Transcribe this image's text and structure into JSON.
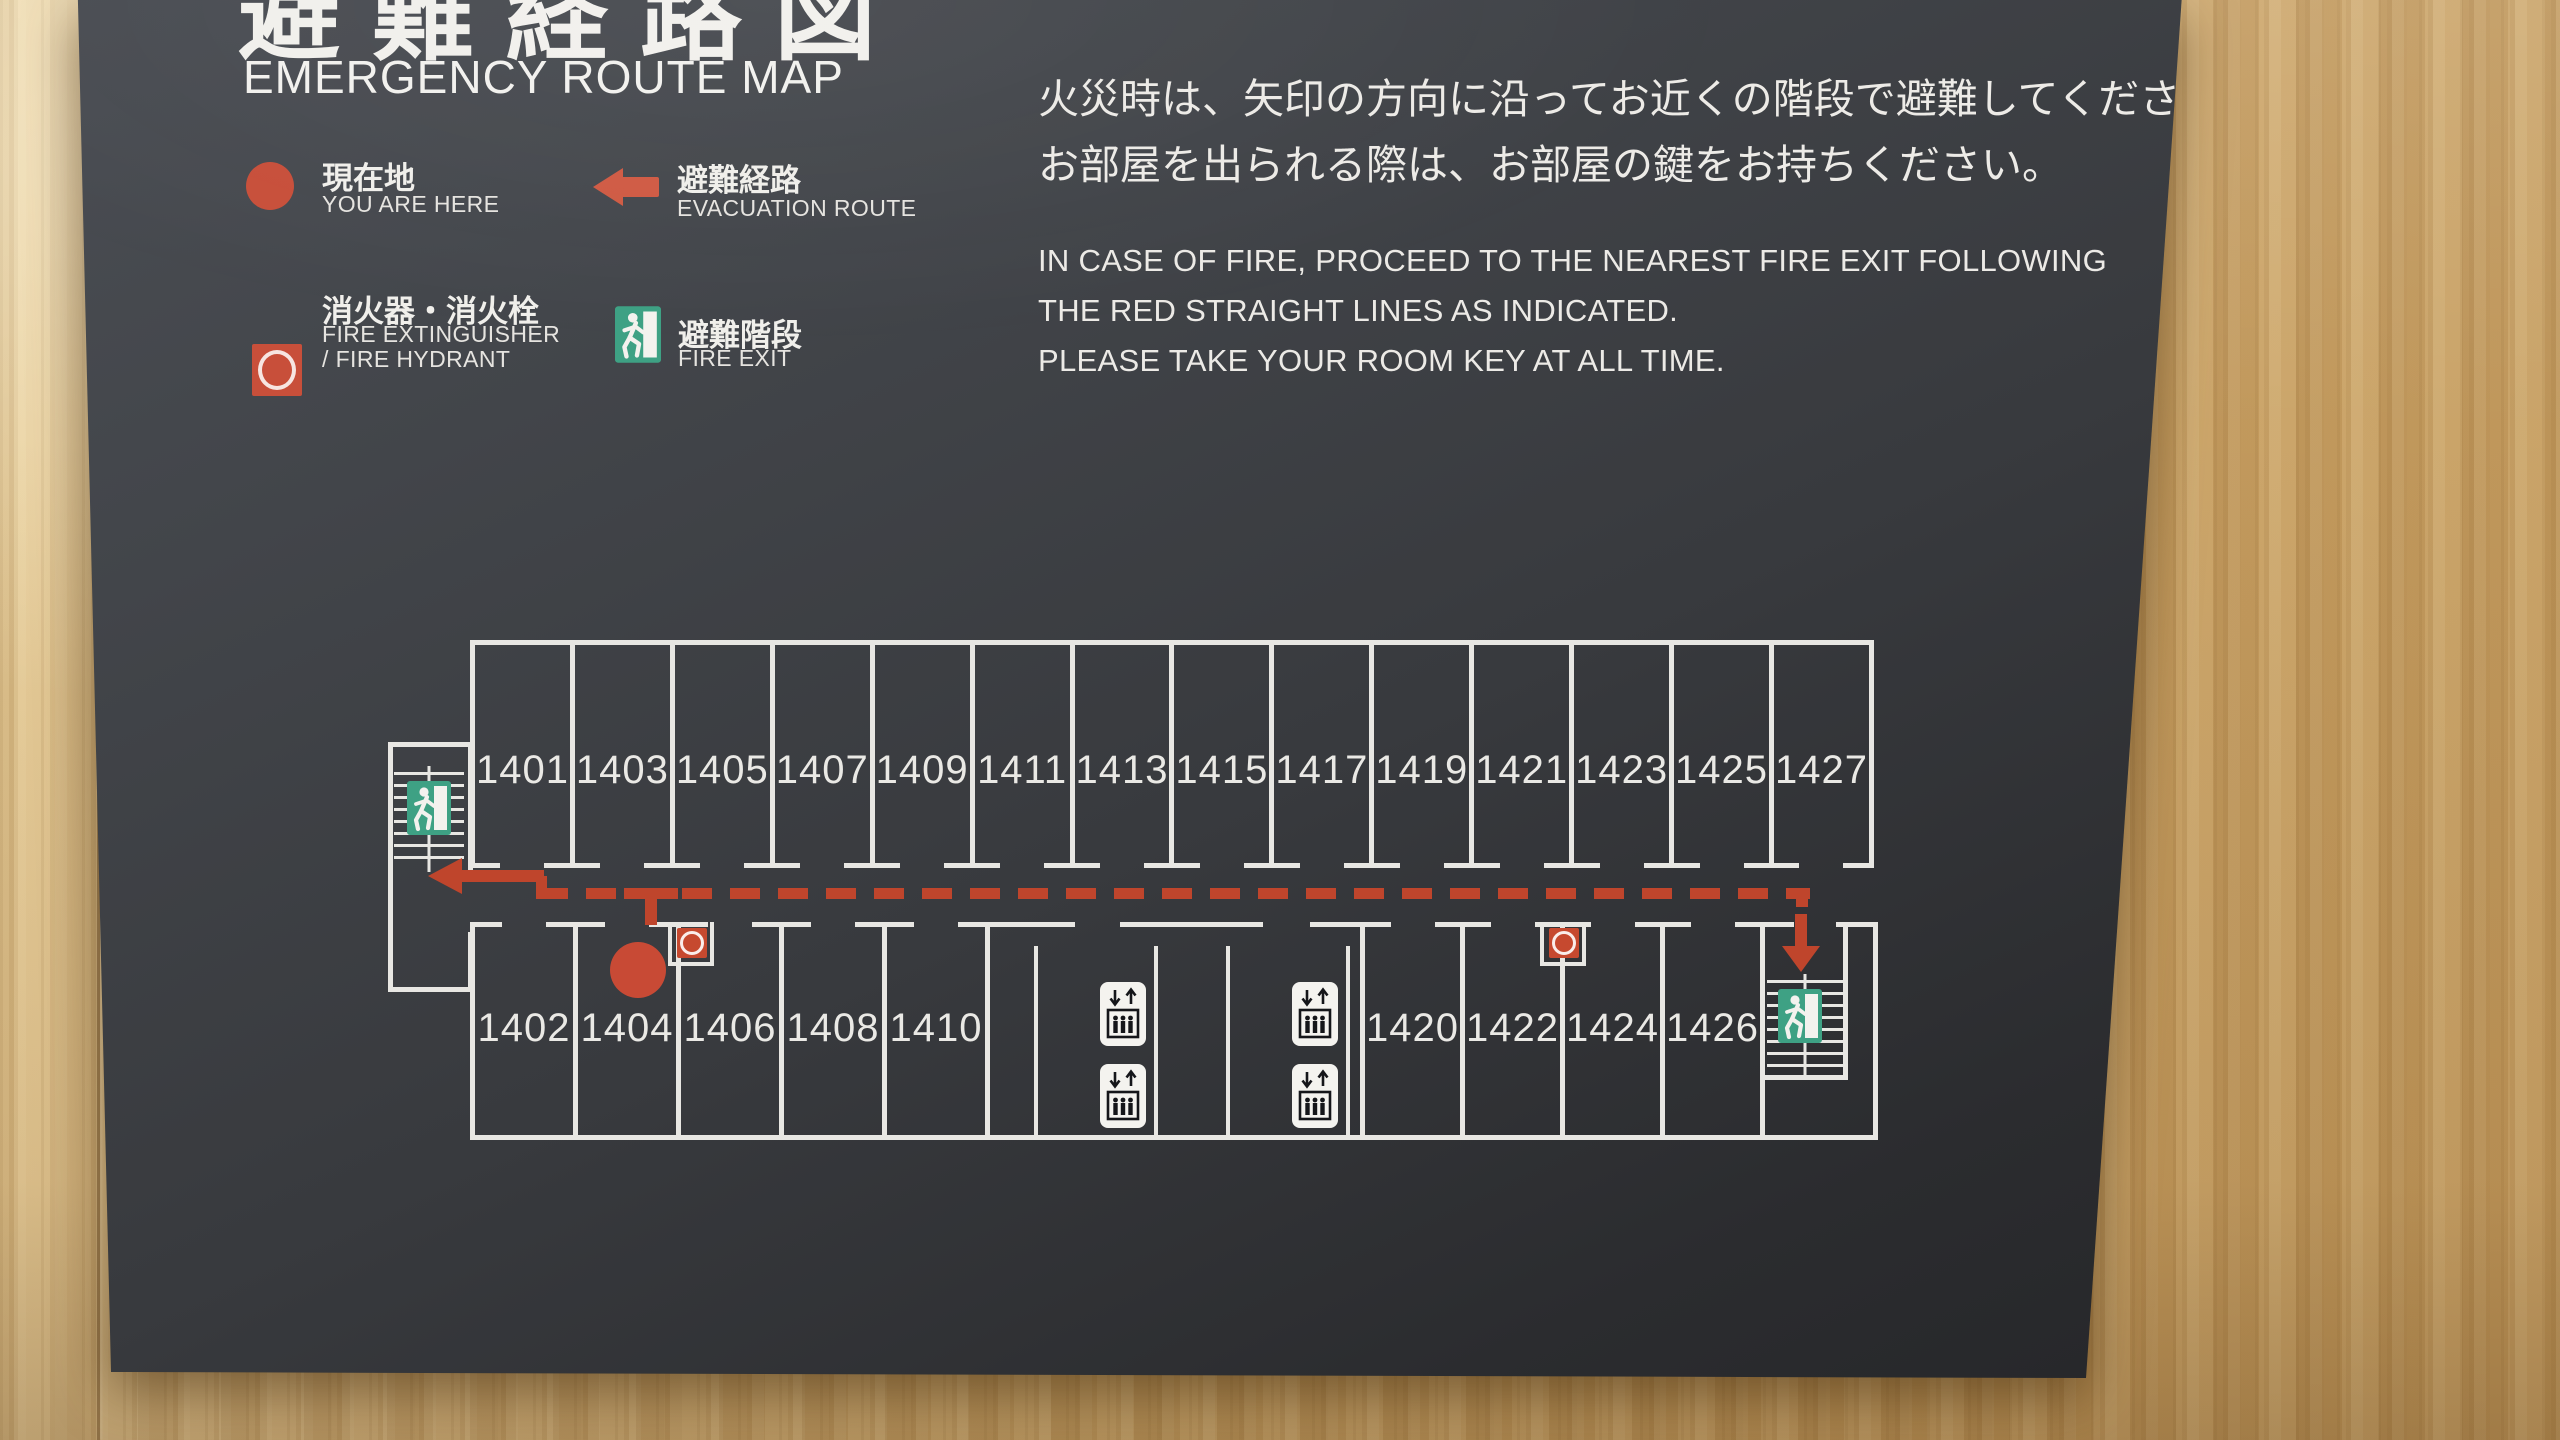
{
  "sign": {
    "title_jp": "避難経路図",
    "title_en": "EMERGENCY ROUTE MAP",
    "notice_jp": [
      "火災時は、矢印の方向に沿ってお近くの階段で避難してください。",
      "お部屋を出られる際は、お部屋の鍵をお持ちください。"
    ],
    "notice_en": [
      "IN CASE OF FIRE, PROCEED TO THE NEAREST FIRE EXIT FOLLOWING",
      "THE RED STRAIGHT LINES AS INDICATED.",
      "PLEASE TAKE YOUR ROOM KEY AT ALL TIME."
    ]
  },
  "legend": {
    "you_are_here": {
      "jp": "現在地",
      "en": "YOU ARE HERE"
    },
    "evacuation_route": {
      "jp": "避難経路",
      "en": "EVACUATION ROUTE"
    },
    "fire_extinguisher": {
      "jp": "消火器・消火栓",
      "en1": "FIRE EXTINGUISHER",
      "en2": "/ FIRE HYDRANT"
    },
    "fire_exit": {
      "jp": "避難階段",
      "en": "FIRE EXIT"
    }
  },
  "floorplan": {
    "rooms_top": [
      "1401",
      "1403",
      "1405",
      "1407",
      "1409",
      "1411",
      "1413",
      "1415",
      "1417",
      "1419",
      "1421",
      "1423",
      "1425",
      "1427"
    ],
    "rooms_bottom_left": [
      "1402",
      "1404",
      "1406",
      "1408",
      "1410"
    ],
    "rooms_bottom_right": [
      "1420",
      "1422",
      "1424",
      "1426"
    ]
  },
  "colors": {
    "panel": "#35373b",
    "route_red": "#bf452c",
    "exit_green": "#3ea184",
    "line_white": "#e8e7e3",
    "wood": "#cfa96b"
  }
}
